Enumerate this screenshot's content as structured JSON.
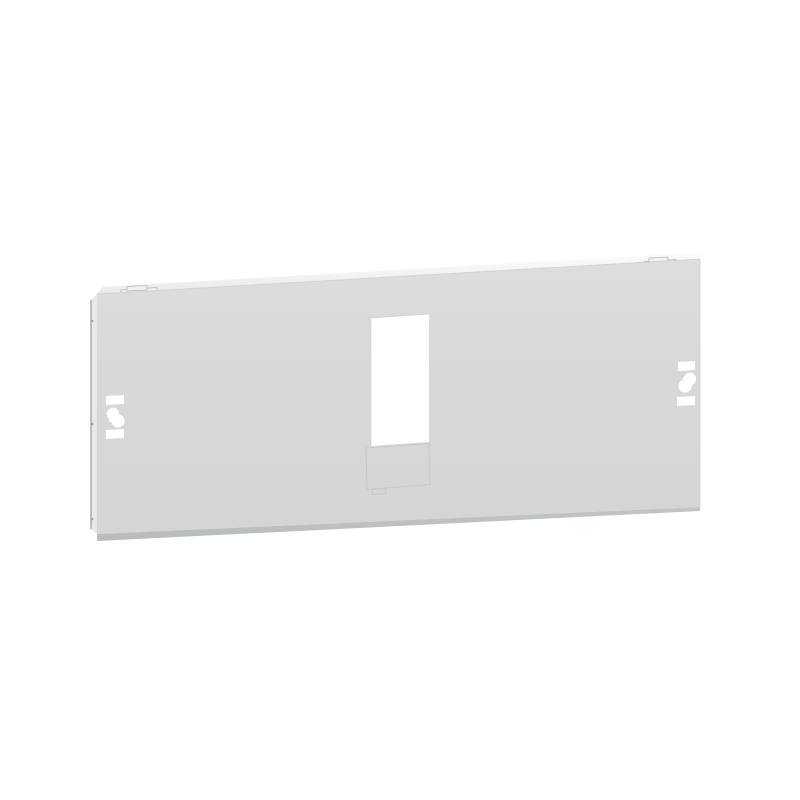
{
  "image": {
    "alt": "Product photo: light grey rectangular electrical enclosure front plate shown in slight perspective, with a central rectangular device cutout, a breakable knockout cover section below the cutout, quarter-turn fastener slots on the left and right sides, and two small mounting clips on the top edge."
  },
  "product": {
    "kind": "enclosure-front-plate",
    "features": [
      "central device cutout",
      "knockout cover below cutout",
      "left fastener slot group",
      "right fastener slot group",
      "top mounting clip left",
      "top mounting clip right"
    ]
  },
  "colors": {
    "background": "#ffffff",
    "panel_face_light": "#dcdedf",
    "panel_face": "#d7d9da",
    "panel_face_dark": "#d3d5d6",
    "top_edge_highlight": "#fdfdfd",
    "top_edge_shade": "#e8eaeb",
    "fold_line": "#c9cccd",
    "left_edge": "#e7e8e9",
    "left_edge_outline": "#989b9d",
    "bottom_edge_dark": "#c2c5c6",
    "bottom_edge_darker": "#b8bbbc",
    "right_edge_line": "#cfd2d3",
    "clip_fill": "#f0f1f2",
    "clip_outline": "#b3b6b7",
    "cutout": "#ffffff",
    "cutout_rim": "#c2c5c6",
    "knockout_line": "#c6c8c9",
    "rivet": "#9b9ea0"
  }
}
